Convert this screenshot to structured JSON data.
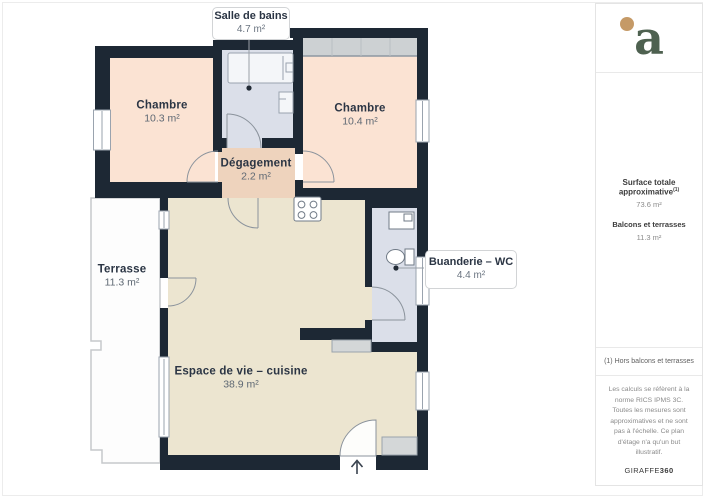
{
  "plan": {
    "callouts": {
      "salle_de_bains": {
        "name": "Salle de bains",
        "area": "4.7 m²"
      },
      "buanderie": {
        "name": "Buanderie – WC",
        "area": "4.4 m²"
      }
    },
    "rooms": {
      "chambre_1": {
        "name": "Chambre",
        "area": "10.3 m²"
      },
      "chambre_2": {
        "name": "Chambre",
        "area": "10.4 m²"
      },
      "degagement": {
        "name": "Dégagement",
        "area": "2.2 m²"
      },
      "terrasse": {
        "name": "Terrasse",
        "area": "11.3 m²"
      },
      "espace_de_vie": {
        "name": "Espace de vie – cuisine",
        "area": "38.9 m²"
      }
    }
  },
  "sidebar": {
    "logo_letter": "a",
    "summary": {
      "total_label": "Surface totale approximative",
      "total_superscript": "(1)",
      "total_value": "73.6 m²",
      "balcony_label": "Balcons et terrasses",
      "balcony_value": "11.3 m²"
    },
    "footnote": "(1) Hors balcons et terrasses",
    "disclaimer": "Les calculs se réfèrent à la norme RICS IPMS 3C. Toutes les mesures sont approximatives et ne sont pas à l'échelle. Ce plan d'étage n'a qu'un but illustratif.",
    "brand": {
      "name": "GIRAFFE",
      "suffix": "360"
    }
  },
  "colors": {
    "wall": "#1d2834",
    "bedroom_fill": "#fbe3d3",
    "hall_fill": "#eed3bd",
    "wet_room_fill": "#dbdfe9",
    "living_fill": "#ece5d0",
    "terrace_fill": "#fdfdfd",
    "furniture_gray": "#cdd1d3",
    "logo_green": "#4e6150",
    "logo_dot": "#c59a67"
  }
}
